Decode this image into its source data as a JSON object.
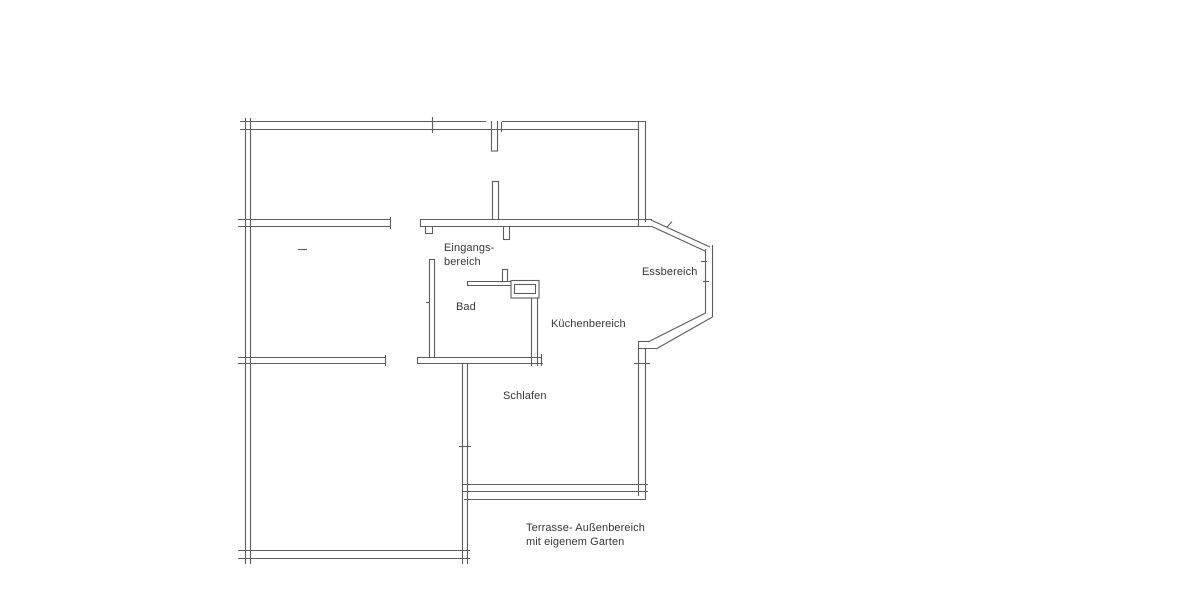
{
  "floorplan": {
    "type": "apartment-floor-plan",
    "colors": {
      "background": "#ffffff",
      "wall_line": "#5d5d5d",
      "label_text": "#383838"
    },
    "rooms": [
      {
        "id": "entrance",
        "label_lines": [
          "Eingangs-",
          "bereich"
        ]
      },
      {
        "id": "bathroom",
        "label_lines": [
          "Bad"
        ]
      },
      {
        "id": "kitchen",
        "label_lines": [
          "Küchenbereich"
        ]
      },
      {
        "id": "dining",
        "label_lines": [
          "Essbereich"
        ]
      },
      {
        "id": "sleeping",
        "label_lines": [
          "Schlafen"
        ]
      },
      {
        "id": "terrace",
        "label_lines": [
          "Terrasse- Außenbereich",
          "mit eigenem Garten"
        ]
      }
    ]
  }
}
